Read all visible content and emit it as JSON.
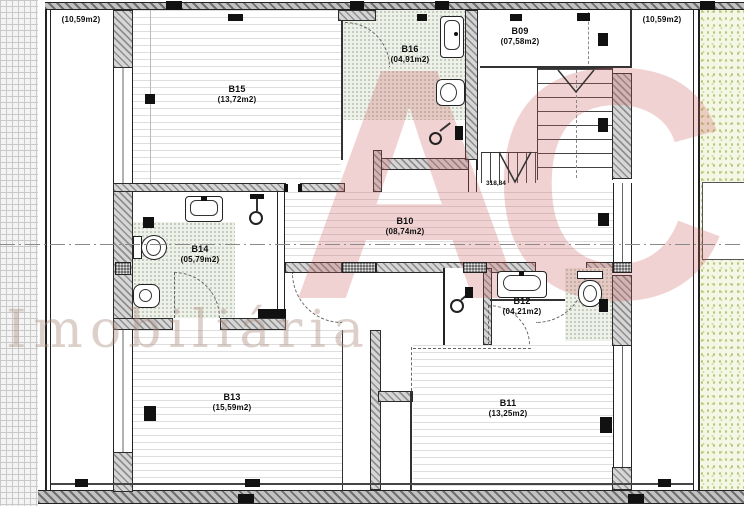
{
  "plan": {
    "rooms": {
      "b09": {
        "name": "B09",
        "area": "(07,58m2)"
      },
      "b10": {
        "name": "B10",
        "area": "(08,74m2)"
      },
      "b11": {
        "name": "B11",
        "area": "(13,25m2)"
      },
      "b12": {
        "name": "B12",
        "area": "(04,21m2)"
      },
      "b13": {
        "name": "B13",
        "area": "(15,59m2)"
      },
      "b14": {
        "name": "B14",
        "area": "(05,79m2)"
      },
      "b15": {
        "name": "B15",
        "area": "(13,72m2)"
      },
      "b16": {
        "name": "B16",
        "area": "(04,91m2)"
      },
      "balcony_left": {
        "area": "(10,59m2)"
      },
      "balcony_right": {
        "area": "(10,59m2)"
      }
    },
    "annotations": {
      "stair_level": "318,84"
    },
    "watermark": {
      "monogram": "AC",
      "text": "Imobiliária",
      "monogram_color": "#c95f5f",
      "text_color": "#af8e80"
    }
  }
}
